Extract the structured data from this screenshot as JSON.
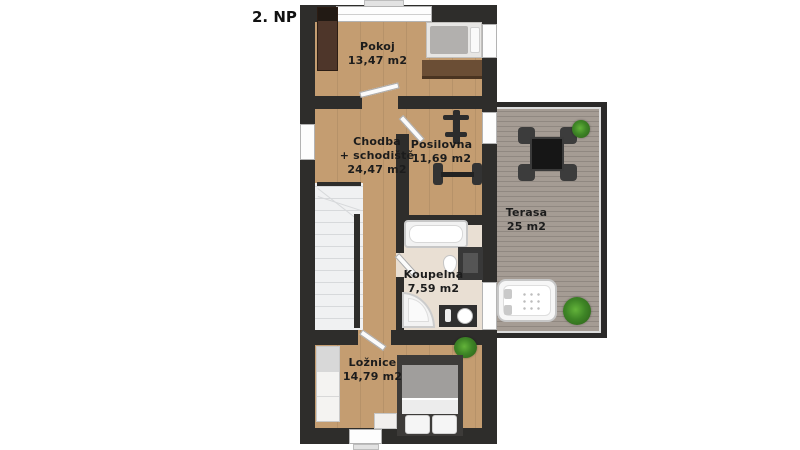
{
  "floor_label": "2. NP",
  "rooms": {
    "pokoj": {
      "name": "Pokoj",
      "area": "13,47 m2"
    },
    "chodba": {
      "name": "Chodba",
      "name_line2": "+ schodiště",
      "area": "24,47 m2"
    },
    "posilovna": {
      "name": "Posilovna",
      "area": "11,69 m2"
    },
    "koupelna": {
      "name": "Koupelna",
      "area": "7,59 m2"
    },
    "terasa": {
      "name": "Terasa",
      "area": "25 m2"
    },
    "loznice": {
      "name": "Ložnice",
      "area": "14,79 m2"
    }
  },
  "colors": {
    "wall": "#2e2d2b",
    "wood": "#c49d71",
    "bath": "#e9dfd3",
    "stairs": "#f0f1f2",
    "deck": "#a59c94",
    "plant": "#3e8526",
    "text": "#1c1c1c"
  }
}
